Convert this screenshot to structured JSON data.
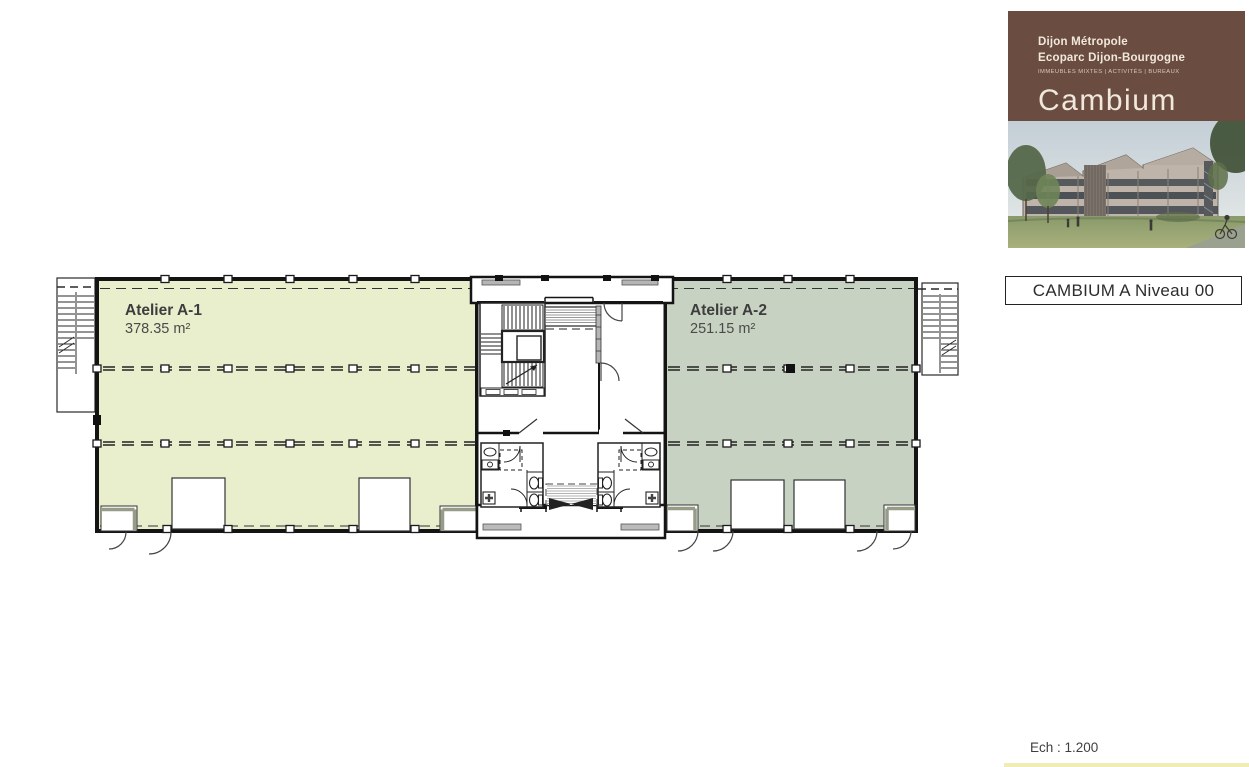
{
  "panel": {
    "org_line1": "Dijon Métropole",
    "org_line2": "Ecoparc Dijon-Bourgogne",
    "tagline": "IMMEUBLES MIXTES | ACTIVITÉS | BUREAUX",
    "brand": "Cambium",
    "brand_sub": "A & B"
  },
  "title_box": {
    "label": "CAMBIUM A Niveau 00"
  },
  "scale": {
    "label": "Ech : 1.200"
  },
  "plan": {
    "rooms": [
      {
        "id": "A-1",
        "name": "Atelier A-1",
        "area": "378.35 m²",
        "fill": "#e9efcd"
      },
      {
        "id": "A-2",
        "name": "Atelier A-2",
        "area": "251.15 m²",
        "fill": "#c8d2c2"
      }
    ]
  },
  "colors": {
    "panel_brown": "#6a4c41",
    "brand_cream": "#f0e8db",
    "brand_gold": "#dfa245",
    "room_a1_fill": "#e9efcd",
    "room_a2_fill": "#c8d2c2",
    "wall": "#141414"
  }
}
